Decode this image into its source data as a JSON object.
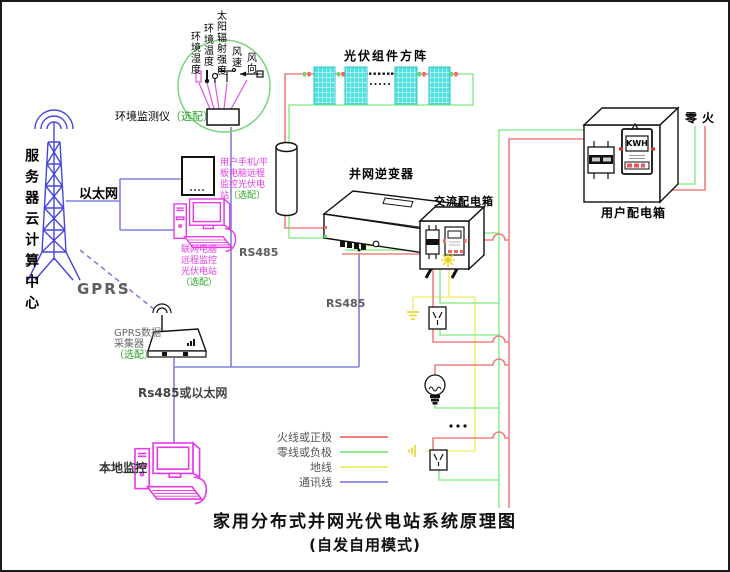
{
  "title": {
    "line1": "家用分布式并网光伏电站系统原理图",
    "line2": "(自发自用模式)"
  },
  "cloud": {
    "tower_label": "服务器云计算中心",
    "ethernet": "以太网",
    "gprs": "GPRS"
  },
  "monitoring": {
    "tablet_note": {
      "l1": "用户手机/平",
      "l2": "板电脑远程",
      "l3": "监控光伏电",
      "l4a": "站",
      "l4b": "〔选配〕"
    },
    "pc_note": {
      "l1": "联网电脑",
      "l2": "远程监控",
      "l3": "光伏电站",
      "l4": "（选配）"
    },
    "collector_note": {
      "l1": "GPRS数据",
      "l2": "采集器",
      "l3": "（选配）"
    },
    "rs485_or_eth": "Rs485或以太网",
    "local_monitor": "本地监控",
    "rs485_left": "RS485",
    "rs485_right": "RS485"
  },
  "env": {
    "label": "环境监测仪",
    "optional": "（选配）",
    "sensors": [
      "环境湿度",
      "环境温度",
      "太阳辐射强度",
      "风速",
      "风向"
    ]
  },
  "pv": {
    "label": "光伏组件方阵",
    "ellipsis": "……"
  },
  "inverter": {
    "label": "并网逆变器"
  },
  "acbox": {
    "label": "交流配电箱"
  },
  "userbox": {
    "label": "用户配电箱",
    "neutral_live": "零火",
    "meter": "KWH"
  },
  "loads": {
    "ellipsis": "..."
  },
  "legend": {
    "items": [
      {
        "label": "火线或正极",
        "color": "#f08080"
      },
      {
        "label": "零线或负极",
        "color": "#90ee90"
      },
      {
        "label": "地线",
        "color": "#efef78"
      },
      {
        "label": "通讯线",
        "color": "#9393e0"
      }
    ]
  }
}
